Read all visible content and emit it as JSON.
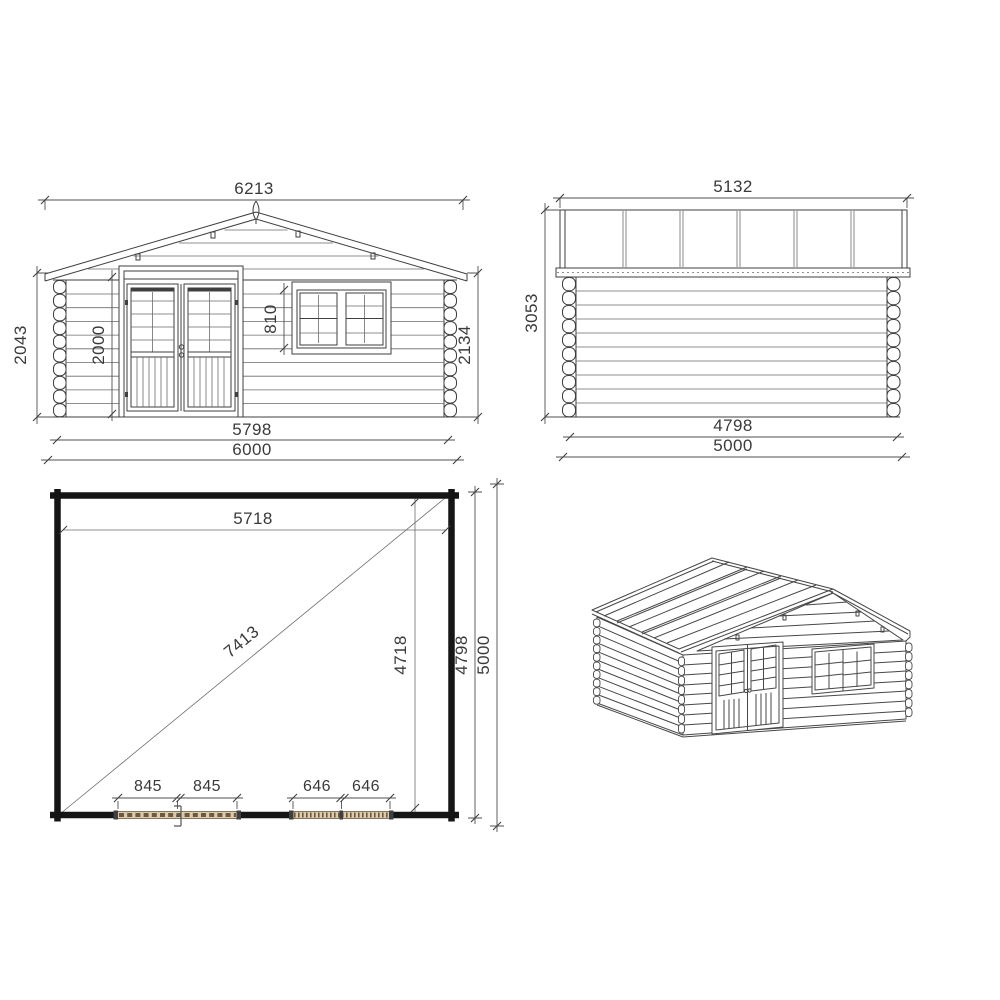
{
  "sheet": {
    "title": "Log cabin technical drawing",
    "background": "#ffffff"
  },
  "colors": {
    "line": "#3f3f3f",
    "dimension_line": "#4f4f4f",
    "text": "#3a3a3a",
    "plan_wall": "#151515",
    "opening_fill": "#dccbaa",
    "opening_hatch": "#6e5a42"
  },
  "views": {
    "front_elevation": {
      "label": "front elevation",
      "dim_roof_width": "6213",
      "dim_height_left": "2043",
      "dim_door_height": "2000",
      "dim_window_height": "810",
      "dim_height_right": "2134",
      "dim_wall_width": "5798",
      "dim_total_width": "6000"
    },
    "side_elevation": {
      "label": "side elevation",
      "dim_roof_depth": "5132",
      "dim_height": "3053",
      "dim_wall_depth": "4798",
      "dim_total_depth": "5000"
    },
    "floor_plan": {
      "label": "floor plan",
      "dim_inner_width": "5718",
      "dim_diagonal": "7413",
      "dim_inner_depth": "4718",
      "dim_side_depth": "4798",
      "dim_total_depth": "5000",
      "dim_door_half_a": "845",
      "dim_door_half_b": "845",
      "dim_window_half_a": "646",
      "dim_window_half_b": "646"
    },
    "perspective": {
      "label": "3D view"
    }
  }
}
